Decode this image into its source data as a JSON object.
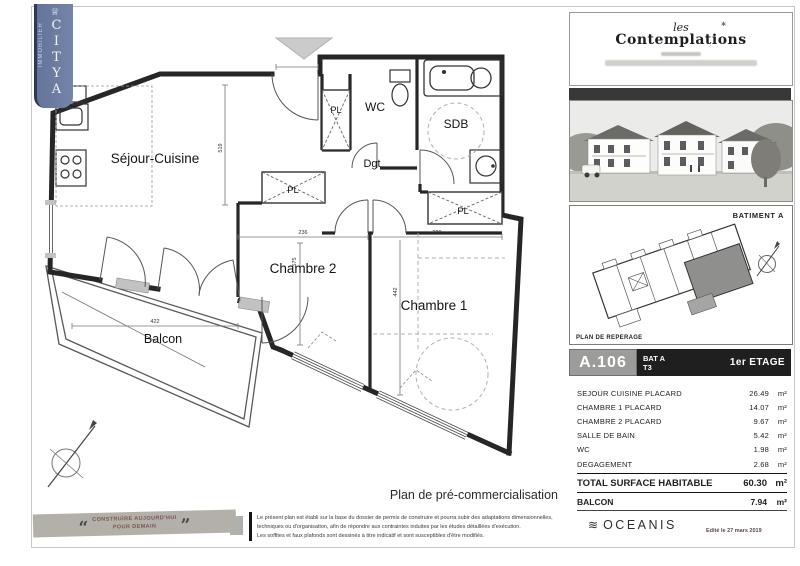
{
  "branding": {
    "citya_word": "CITYA",
    "citya_sub": "IMMOBILIER",
    "program_script": "les",
    "program_name": "Contemplations",
    "oceanis": "OCEANIS",
    "edit_date": "Edité le 27 mars 2019"
  },
  "icons": {
    "crown": "♕",
    "wave": "≋",
    "quote_open": "“",
    "quote_close": "”"
  },
  "keyplan": {
    "batiment": "BATIMENT A",
    "caption": "PLAN DE REPERAGE"
  },
  "unit": {
    "code": "A.106",
    "bat": "BAT A",
    "type": "T3",
    "floor": "1er ETAGE"
  },
  "surfaces": {
    "rows": [
      {
        "label": "SEJOUR CUISINE PLACARD",
        "value": "26.49",
        "unit": "m²"
      },
      {
        "label": "CHAMBRE 1  PLACARD",
        "value": "14.07",
        "unit": "m²"
      },
      {
        "label": "CHAMBRE 2  PLACARD",
        "value": "9.67",
        "unit": "m²"
      },
      {
        "label": "SALLE DE BAIN",
        "value": "5.42",
        "unit": "m²"
      },
      {
        "label": "WC",
        "value": "1.98",
        "unit": "m²"
      },
      {
        "label": "DEGAGEMENT",
        "value": "2.68",
        "unit": "m²"
      }
    ],
    "total": {
      "label": "TOTAL SURFACE HABITABLE",
      "value": "60.30",
      "unit": "m²"
    },
    "balcon": {
      "label": "BALCON",
      "value": "7.94",
      "unit": "m²"
    }
  },
  "plan": {
    "rooms": {
      "sejour": "Séjour-Cuisine",
      "chambre2": "Chambre 2",
      "chambre1": "Chambre 1",
      "balcon": "Balcon",
      "wc": "WC",
      "sdb": "SDB",
      "dgt": "Dgt",
      "pl": "PL"
    },
    "dims": {
      "ch2_w": "236",
      "ch1_w": "280",
      "ch2_h": "575",
      "ch1_h": "442",
      "sejour_h": "519",
      "balcon_w": "422"
    }
  },
  "footer": {
    "title": "Plan de pré-commercialisation",
    "disclaimer_l1": "Le présent plan est établi sur la base du dossier de permis de construire et pourra subir des adaptations dimensionnelles,",
    "disclaimer_l2": "techniques ou d'organisation, afin de répondre aux contraintes induites par les études détaillées d'exécution.",
    "disclaimer_l3": "Les soffites et faux plafonds sont dessinés à titre indicatif et sont susceptibles d'être modifiés.",
    "slogan_l1": "CONSTRUIRE AUJOURD'HUI",
    "slogan_l2": "POUR DEMAIN"
  }
}
